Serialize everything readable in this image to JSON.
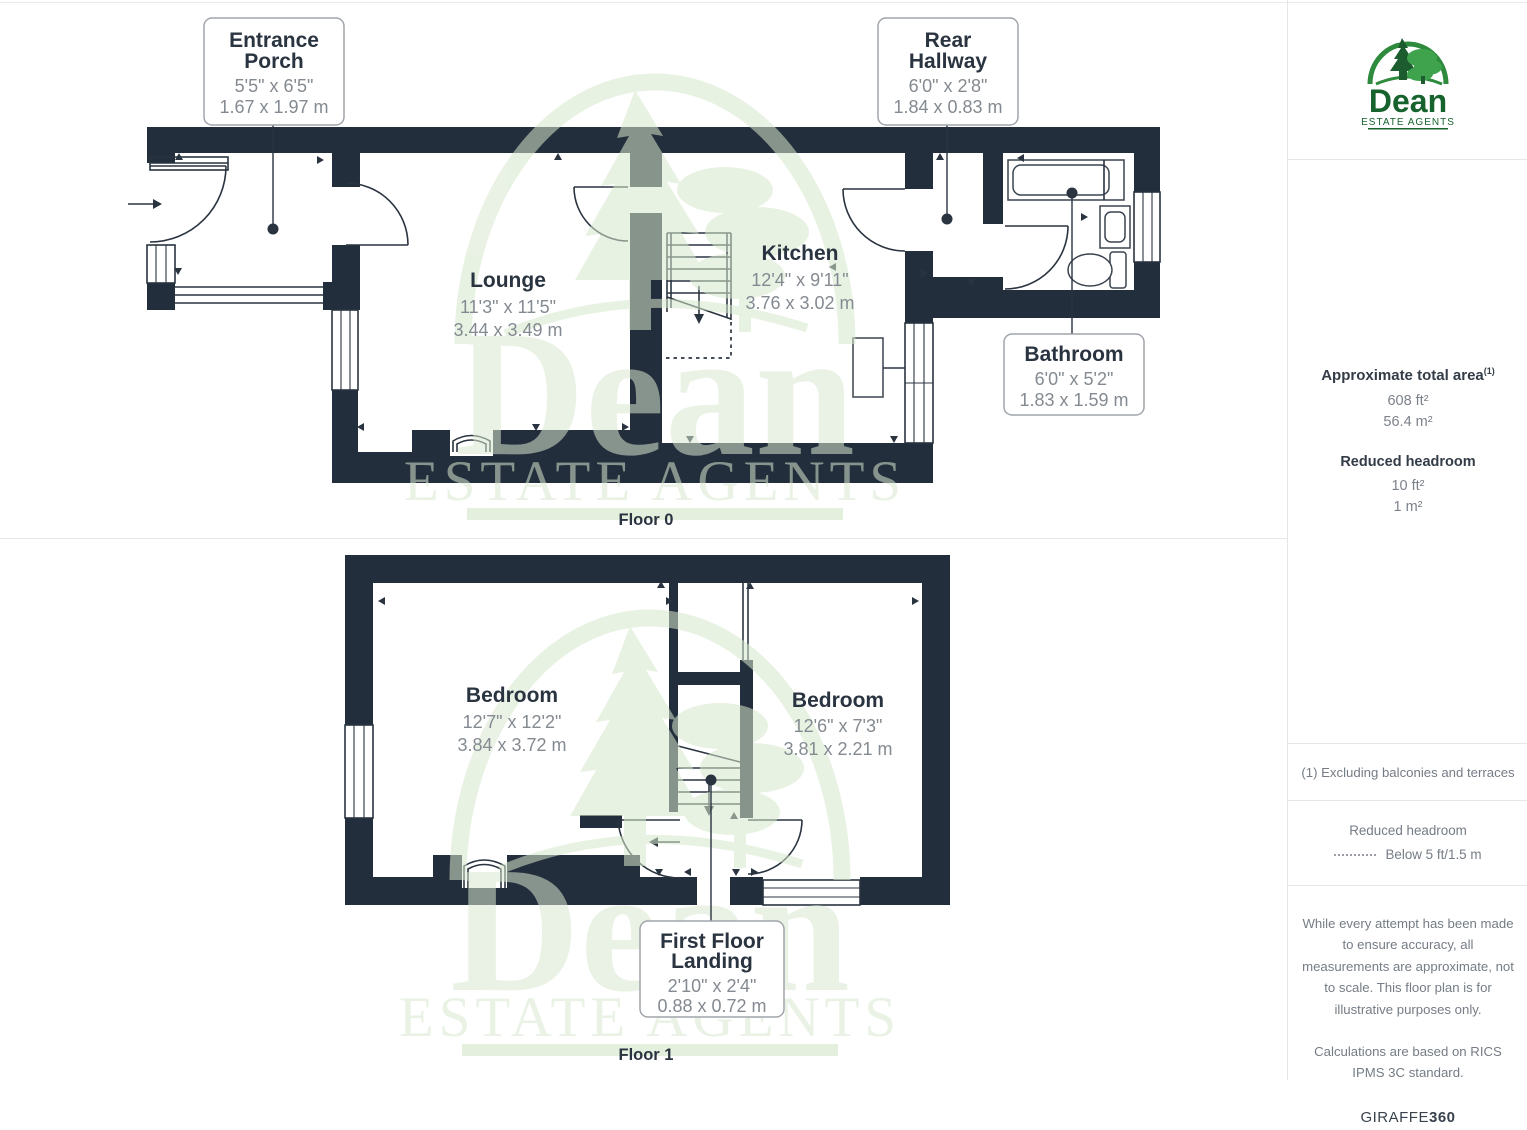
{
  "watermark": {
    "name": "Dean",
    "tagline": "ESTATE AGENTS"
  },
  "floor0": {
    "caption": "Floor 0",
    "room_labels": {
      "lounge": {
        "title": "Lounge",
        "imperial": "11'3\" x 11'5\"",
        "metric": "3.44 x 3.49 m"
      },
      "kitchen": {
        "title": "Kitchen",
        "imperial": "12'4\" x 9'11\"",
        "metric": "3.76 x 3.02 m"
      }
    },
    "boxed_labels": {
      "entrance_porch": {
        "line1": "Entrance",
        "line2": "Porch",
        "imperial": "5'5\" x 6'5\"",
        "metric": "1.67 x 1.97 m"
      },
      "rear_hallway": {
        "line1": "Rear",
        "line2": "Hallway",
        "imperial": "6'0\" x 2'8\"",
        "metric": "1.84 x 0.83 m"
      },
      "bathroom": {
        "title": "Bathroom",
        "imperial": "6'0\" x 5'2\"",
        "metric": "1.83 x 1.59 m"
      }
    }
  },
  "floor1": {
    "caption": "Floor 1",
    "room_labels": {
      "bedroom_left": {
        "title": "Bedroom",
        "imperial": "12'7\" x 12'2\"",
        "metric": "3.84 x 3.72 m"
      },
      "bedroom_right": {
        "title": "Bedroom",
        "imperial": "12'6\" x 7'3\"",
        "metric": "3.81 x 2.21 m"
      }
    },
    "boxed_labels": {
      "first_floor_landing": {
        "line1": "First Floor",
        "line2": "Landing",
        "imperial": "2'10\" x 2'4\"",
        "metric": "0.88 x 0.72 m"
      }
    }
  },
  "sidebar": {
    "logo": {
      "name": "Dean",
      "tagline": "ESTATE AGENTS"
    },
    "area": {
      "title": "Approximate total area",
      "footnote_marker": "(1)",
      "imperial": "608 ft²",
      "metric": "56.4 m²"
    },
    "reduced_headroom": {
      "title": "Reduced headroom",
      "imperial": "10 ft²",
      "metric": "1 m²"
    },
    "footnote": "(1) Excluding balconies and terraces",
    "legend": {
      "title": "Reduced headroom",
      "item": "Below 5 ft/1.5 m"
    },
    "disclaimer1": "While every attempt has been made to ensure accuracy, all measurements are approximate, not to scale. This floor plan is for illustrative purposes only.",
    "disclaimer2": "Calculations are based on RICS IPMS 3C standard.",
    "brand": {
      "name": "GIRAFFE",
      "suffix": "360"
    }
  },
  "colors": {
    "wall": "#232e3c",
    "room_title_text": "#2a3440",
    "dimension_text": "#848a91",
    "watermark_green": "#d9e9d0",
    "logo_green_dark": "#17632e",
    "logo_green_bright": "#3fa24c",
    "muted_text": "#757c85"
  }
}
